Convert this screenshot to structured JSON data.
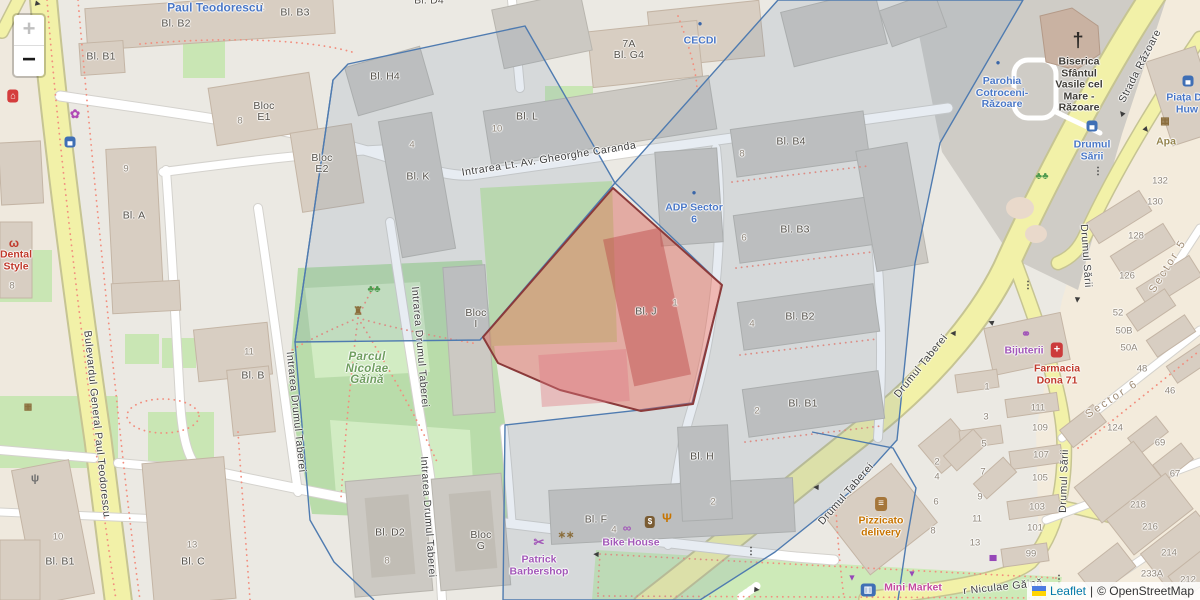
{
  "controls": {
    "zoom_in": "+",
    "zoom_out": "−"
  },
  "attribution": {
    "leaflet": "Leaflet",
    "separator": "|",
    "osm": "© OpenStreetMap",
    "flag_top": "#4c7be1",
    "flag_bottom": "#ffd500"
  },
  "colors": {
    "highlight_fill": "#d9564a",
    "highlight_stroke": "#8b3a3a",
    "boundary_blue": "#4f7bb0",
    "road_yellow": "#f2f1a8",
    "park_green": "#b9dcaa",
    "poi_blue": "#4a77c6",
    "poi_purple": "#a257b8",
    "poi_red": "#c0392b",
    "poi_orange": "#c77400",
    "poi_green": "#6f9e5f",
    "poi_khaki": "#94844d",
    "poi_magenta": "#c34b9e"
  },
  "map": {
    "street_labels": [
      {
        "name": "street-bulevardul-general-paul-teodorescu",
        "text": "Bulevardul General Paul Teodorescu",
        "x": 97,
        "y": 424,
        "rot": 84
      },
      {
        "name": "street-intrarea-lt-av-gheorghe-caranda",
        "text": "Intrarea Lt. Av. Gheorghe Caranda",
        "x": 549,
        "y": 159,
        "rot": -9
      },
      {
        "name": "street-intrarea-drumul-taberei-1",
        "text": "Intrarea Drumul Taberei",
        "x": 296,
        "y": 412,
        "rot": 84
      },
      {
        "name": "street-intrarea-drumul-taberei-2",
        "text": "Intrarea Drumul Taberei",
        "x": 420,
        "y": 347,
        "rot": 85
      },
      {
        "name": "street-intrarea-drumul-taberei-3",
        "text": "Intrarea Drumul Taberei",
        "x": 428,
        "y": 517,
        "rot": 86
      },
      {
        "name": "street-drumul-taberei-1",
        "text": "Drumul Taberei",
        "x": 921,
        "y": 366,
        "rot": -51
      },
      {
        "name": "street-drumul-taberei-2",
        "text": "Drumul Taberei",
        "x": 846,
        "y": 494,
        "rot": -49
      },
      {
        "name": "street-strada-razoare",
        "text": "Strada Răzoare",
        "x": 1140,
        "y": 66,
        "rot": -63
      },
      {
        "name": "street-drumul-sarii-1",
        "text": "Drumul Sării",
        "x": 1086,
        "y": 256,
        "rot": 86
      },
      {
        "name": "street-drumul-sarii-2",
        "text": "Drumul Sării",
        "x": 1064,
        "y": 481,
        "rot": -88
      },
      {
        "name": "street-niculae-gaina",
        "text": "r Niculae Găină",
        "x": 1003,
        "y": 587,
        "rot": -6
      }
    ],
    "place_labels": [
      {
        "name": "place-sector-5",
        "text": "Sector 5",
        "x": 1168,
        "y": 266,
        "rot": -58
      },
      {
        "name": "place-sector-6",
        "text": "Sector 6",
        "x": 1112,
        "y": 399,
        "rot": -33
      }
    ],
    "building_labels": [
      {
        "text": "Bl. D4",
        "x": 429,
        "y": 1
      },
      {
        "text": "Bl. B3",
        "x": 295,
        "y": 13
      },
      {
        "text": "Bl. B2",
        "x": 176,
        "y": 24
      },
      {
        "text": "Bl. B1",
        "x": 101,
        "y": 57
      },
      {
        "text": "Bloc\nE1",
        "x": 264,
        "y": 112
      },
      {
        "text": "Bloc\nE2",
        "x": 322,
        "y": 164
      },
      {
        "text": "Bl. H4",
        "x": 385,
        "y": 77
      },
      {
        "text": "Bl. K",
        "x": 418,
        "y": 177
      },
      {
        "text": "Bl. L",
        "x": 527,
        "y": 117
      },
      {
        "text": "7A\nBl. G4",
        "x": 629,
        "y": 50
      },
      {
        "text": "Bl. B4",
        "x": 791,
        "y": 142
      },
      {
        "text": "Bl. B3",
        "x": 795,
        "y": 230
      },
      {
        "text": "Bl. B2",
        "x": 800,
        "y": 317
      },
      {
        "text": "Bl. B1",
        "x": 803,
        "y": 404
      },
      {
        "text": "Bl. J",
        "x": 646,
        "y": 312
      },
      {
        "text": "Bloc\nI",
        "x": 476,
        "y": 319
      },
      {
        "text": "Bl. A",
        "x": 134,
        "y": 216
      },
      {
        "text": "Bl. B",
        "x": 253,
        "y": 376
      },
      {
        "text": "Bl. B1",
        "x": 60,
        "y": 562
      },
      {
        "text": "Bl. C",
        "x": 193,
        "y": 562
      },
      {
        "text": "Bl. D2",
        "x": 390,
        "y": 533
      },
      {
        "text": "Bloc\nG",
        "x": 481,
        "y": 541
      },
      {
        "text": "Bl. F",
        "x": 596,
        "y": 520
      },
      {
        "text": "Bl. H",
        "x": 702,
        "y": 457
      }
    ],
    "house_numbers": [
      {
        "text": "11",
        "x": 260,
        "y": 7
      },
      {
        "text": "8",
        "x": 240,
        "y": 121
      },
      {
        "text": "9",
        "x": 126,
        "y": 169
      },
      {
        "text": "4",
        "x": 412,
        "y": 145
      },
      {
        "text": "10",
        "x": 497,
        "y": 129
      },
      {
        "text": "8",
        "x": 12,
        "y": 286
      },
      {
        "text": "11",
        "x": 249,
        "y": 352
      },
      {
        "text": "8",
        "x": 742,
        "y": 154
      },
      {
        "text": "6",
        "x": 744,
        "y": 238
      },
      {
        "text": "4",
        "x": 752,
        "y": 324
      },
      {
        "text": "2",
        "x": 757,
        "y": 411
      },
      {
        "text": "1",
        "x": 675,
        "y": 303
      },
      {
        "text": "10",
        "x": 58,
        "y": 537
      },
      {
        "text": "13",
        "x": 192,
        "y": 545
      },
      {
        "text": "8",
        "x": 387,
        "y": 561
      },
      {
        "text": "4",
        "x": 614,
        "y": 530
      },
      {
        "text": "2",
        "x": 713,
        "y": 502
      },
      {
        "text": "2",
        "x": 937,
        "y": 462
      },
      {
        "text": "4",
        "x": 937,
        "y": 477
      },
      {
        "text": "6",
        "x": 936,
        "y": 502
      },
      {
        "text": "8",
        "x": 933,
        "y": 531
      },
      {
        "text": "7",
        "x": 983,
        "y": 472
      },
      {
        "text": "9",
        "x": 980,
        "y": 497
      },
      {
        "text": "11",
        "x": 977,
        "y": 519
      },
      {
        "text": "13",
        "x": 975,
        "y": 543
      },
      {
        "text": "132",
        "x": 1160,
        "y": 181
      },
      {
        "text": "130",
        "x": 1155,
        "y": 202
      },
      {
        "text": "128",
        "x": 1136,
        "y": 236
      },
      {
        "text": "126",
        "x": 1127,
        "y": 276
      },
      {
        "text": "52",
        "x": 1118,
        "y": 313
      },
      {
        "text": "50B",
        "x": 1124,
        "y": 331
      },
      {
        "text": "50A",
        "x": 1129,
        "y": 348
      },
      {
        "text": "48",
        "x": 1142,
        "y": 369
      },
      {
        "text": "46",
        "x": 1170,
        "y": 391
      },
      {
        "text": "1",
        "x": 987,
        "y": 387
      },
      {
        "text": "3",
        "x": 986,
        "y": 417
      },
      {
        "text": "5",
        "x": 984,
        "y": 444
      },
      {
        "text": "111",
        "x": 1038,
        "y": 408
      },
      {
        "text": "109",
        "x": 1040,
        "y": 428
      },
      {
        "text": "107",
        "x": 1041,
        "y": 455
      },
      {
        "text": "105",
        "x": 1040,
        "y": 478
      },
      {
        "text": "103",
        "x": 1037,
        "y": 507
      },
      {
        "text": "101",
        "x": 1035,
        "y": 528
      },
      {
        "text": "99",
        "x": 1031,
        "y": 554
      },
      {
        "text": "124",
        "x": 1115,
        "y": 428
      },
      {
        "text": "69",
        "x": 1160,
        "y": 443
      },
      {
        "text": "67",
        "x": 1175,
        "y": 474
      },
      {
        "text": "218",
        "x": 1138,
        "y": 505
      },
      {
        "text": "216",
        "x": 1150,
        "y": 527
      },
      {
        "text": "214",
        "x": 1169,
        "y": 553
      },
      {
        "text": "233A",
        "x": 1152,
        "y": 574
      },
      {
        "text": "212",
        "x": 1188,
        "y": 580
      }
    ],
    "pois": [
      {
        "name": "poi-paul-teodorescu",
        "label": "Paul Teodorescu",
        "x": 215,
        "y": 8,
        "color": "#4a77c6",
        "cls": "big"
      },
      {
        "name": "poi-cecdi",
        "label": "CECDI",
        "x": 700,
        "y": 41,
        "color": "#4a77c6",
        "icon": {
          "name": "poi-dot-icon",
          "glyph": "●",
          "x": 700,
          "y": 24,
          "color": "#3a66a8",
          "size": 8
        }
      },
      {
        "name": "poi-parohia-cotroceni-razoare",
        "label": "Parohia\nCotroceni-\nRăzoare",
        "x": 1002,
        "y": 93,
        "color": "#4a77c6",
        "icon": {
          "name": "poi-dot-icon",
          "glyph": "●",
          "x": 998,
          "y": 63,
          "color": "#3a66a8",
          "size": 8
        }
      },
      {
        "name": "poi-biserica-sfantul-vasile",
        "label": "Biserica\nSfântul\nVasile cel\nMare -\nRăzoare",
        "x": 1079,
        "y": 85,
        "color": "#3d3a35",
        "icon": {
          "name": "church-cross-icon",
          "glyph": "†",
          "x": 1078,
          "y": 41,
          "color": "#2e2b28",
          "size": 20
        }
      },
      {
        "name": "poi-adp-sector-6",
        "label": "ADP Sector\n6",
        "x": 694,
        "y": 214,
        "color": "#4a77c6",
        "icon": {
          "name": "poi-dot-icon",
          "glyph": "●",
          "x": 694,
          "y": 193,
          "color": "#3a66a8",
          "size": 8
        }
      },
      {
        "name": "poi-drumul-sarii-stop",
        "label": "Drumul\nSării",
        "x": 1092,
        "y": 151,
        "color": "#4a77c6",
        "icon": {
          "name": "bus-stop-icon",
          "glyph": "▄",
          "x": 1092,
          "y": 126,
          "color": "#fff",
          "bg": "#3f6fb5",
          "size": 7
        }
      },
      {
        "name": "poi-piata",
        "label": "Piața Da\nHuw",
        "x": 1187,
        "y": 104,
        "color": "#4a77c6",
        "icon": {
          "name": "bus-stop-icon",
          "glyph": "▄",
          "x": 1188,
          "y": 81,
          "color": "#fff",
          "bg": "#3f6fb5",
          "size": 7
        }
      },
      {
        "name": "poi-dental-style",
        "label": "Dental\nStyle",
        "x": 16,
        "y": 261,
        "color": "#c0392b",
        "icon": {
          "name": "tooth-icon",
          "glyph": "ω",
          "x": 14,
          "y": 243,
          "color": "#c0392b",
          "size": 12
        }
      },
      {
        "name": "poi-parcul-nicolae-gaina",
        "label": "Parcul\nNicolae\nGăină",
        "x": 367,
        "y": 369,
        "color": "#6f9e5f",
        "cls": "park"
      },
      {
        "name": "poi-patrick-barbershop",
        "label": "Patrick\nBarbershop",
        "x": 539,
        "y": 566,
        "color": "#a257b8",
        "icon": {
          "name": "scissors-icon",
          "glyph": "✂",
          "x": 539,
          "y": 542,
          "color": "#a257b8",
          "size": 13
        }
      },
      {
        "name": "poi-bike-house",
        "label": "Bike House",
        "x": 631,
        "y": 543,
        "color": "#a257b8",
        "icon": {
          "name": "bicycle-icon",
          "glyph": "∞",
          "x": 627,
          "y": 528,
          "color": "#a257b8",
          "size": 12
        }
      },
      {
        "name": "poi-pizzicato-delivery",
        "label": "Pizzicato\ndelivery",
        "x": 881,
        "y": 527,
        "color": "#c77400",
        "icon": {
          "name": "fast-food-icon",
          "glyph": "≡",
          "x": 881,
          "y": 504,
          "color": "#fff",
          "bg": "#a5763a",
          "size": 10
        }
      },
      {
        "name": "poi-mini-market",
        "label": "Mini Market",
        "x": 913,
        "y": 588,
        "color": "#c34b9e"
      },
      {
        "name": "poi-bijuterii",
        "label": "Bijuterii",
        "x": 1024,
        "y": 351,
        "color": "#a257b8",
        "icon": {
          "name": "ring-icon",
          "glyph": "⚭",
          "x": 1026,
          "y": 334,
          "color": "#a257b8",
          "size": 12
        }
      },
      {
        "name": "poi-farmacia-dona-71",
        "label": "Farmacia\nDona 71",
        "x": 1057,
        "y": 375,
        "color": "#c0392b",
        "icon": {
          "name": "pharmacy-cross-icon",
          "glyph": "+",
          "x": 1057,
          "y": 350,
          "color": "#fff",
          "bg": "#cc3b3b",
          "size": 11
        }
      },
      {
        "name": "poi-apa",
        "label": "Apa",
        "x": 1166,
        "y": 142,
        "color": "#94844d",
        "icon": {
          "name": "waste-basket-icon",
          "glyph": "▦",
          "x": 1165,
          "y": 122,
          "color": "#8a6d3b",
          "size": 10
        }
      }
    ],
    "icons": [
      {
        "name": "florist-icon",
        "glyph": "✿",
        "x": 75,
        "y": 114,
        "color": "#b048b5",
        "size": 12
      },
      {
        "name": "bus-stop-icon",
        "glyph": "▄",
        "x": 70,
        "y": 142,
        "color": "#fff",
        "bg": "#3f6fb5",
        "size": 7
      },
      {
        "name": "shop-icon",
        "glyph": "⌂",
        "x": 13,
        "y": 96,
        "color": "#fff",
        "bg": "#d43d3d",
        "size": 9
      },
      {
        "name": "monument-icon",
        "glyph": "♜",
        "x": 358,
        "y": 312,
        "color": "#8a6d3b",
        "size": 11
      },
      {
        "name": "trees-icon",
        "glyph": "♣♣",
        "x": 374,
        "y": 290,
        "color": "#4e9a4e",
        "size": 10
      },
      {
        "name": "trees-icon",
        "glyph": "♣♣",
        "x": 1042,
        "y": 177,
        "color": "#4e9a4e",
        "size": 10
      },
      {
        "name": "antenna-icon",
        "glyph": "ψ",
        "x": 35,
        "y": 479,
        "color": "#6f6f6f",
        "size": 11
      },
      {
        "name": "waste-basket-icon",
        "glyph": "▦",
        "x": 28,
        "y": 407,
        "color": "#8a6d3b",
        "size": 9
      },
      {
        "name": "people-icon",
        "glyph": "∗∗",
        "x": 566,
        "y": 536,
        "color": "#8a6d3b",
        "size": 10
      },
      {
        "name": "atm-icon",
        "glyph": "$",
        "x": 650,
        "y": 522,
        "color": "#fff",
        "bg": "#7a5c33",
        "size": 8
      },
      {
        "name": "restaurant-icon",
        "glyph": "Ψ",
        "x": 667,
        "y": 518,
        "color": "#c77400",
        "size": 12
      },
      {
        "name": "basket-icon",
        "glyph": "▼",
        "x": 912,
        "y": 574,
        "color": "#9647b8",
        "size": 9
      },
      {
        "name": "basket-icon",
        "glyph": "▼",
        "x": 852,
        "y": 578,
        "color": "#9647b8",
        "size": 9
      },
      {
        "name": "car-wash-icon",
        "glyph": "▄",
        "x": 993,
        "y": 556,
        "color": "#9647b8",
        "size": 10
      },
      {
        "name": "convenience-icon",
        "glyph": "▥",
        "x": 868,
        "y": 590,
        "color": "#fff",
        "bg": "#3f6fb5",
        "size": 9
      },
      {
        "name": "traffic-light-icon",
        "glyph": "⋮",
        "x": 1028,
        "y": 286,
        "color": "#3f3f3f",
        "size": 10
      },
      {
        "name": "traffic-light-icon",
        "glyph": "⋮",
        "x": 751,
        "y": 552,
        "color": "#3f3f3f",
        "size": 10
      },
      {
        "name": "traffic-light-icon",
        "glyph": "⋮",
        "x": 1059,
        "y": 580,
        "color": "#3f3f3f",
        "size": 10
      },
      {
        "name": "traffic-light-icon",
        "glyph": "⋮",
        "x": 1098,
        "y": 172,
        "color": "#3f3f3f",
        "size": 10
      }
    ],
    "oneway": {
      "glyph": "▶"
    },
    "arrows": [
      {
        "x": 38,
        "y": 4,
        "rot": 12
      },
      {
        "x": 953,
        "y": 333,
        "rot": 183
      },
      {
        "x": 991,
        "y": 322,
        "rot": 203
      },
      {
        "x": 1122,
        "y": 113,
        "rot": 230
      },
      {
        "x": 1146,
        "y": 130,
        "rot": 50
      },
      {
        "x": 816,
        "y": 487,
        "rot": 183
      },
      {
        "x": 596,
        "y": 554,
        "rot": 183
      },
      {
        "x": 757,
        "y": 590,
        "rot": 5
      },
      {
        "x": 1077,
        "y": 300,
        "rot": 95
      }
    ]
  }
}
